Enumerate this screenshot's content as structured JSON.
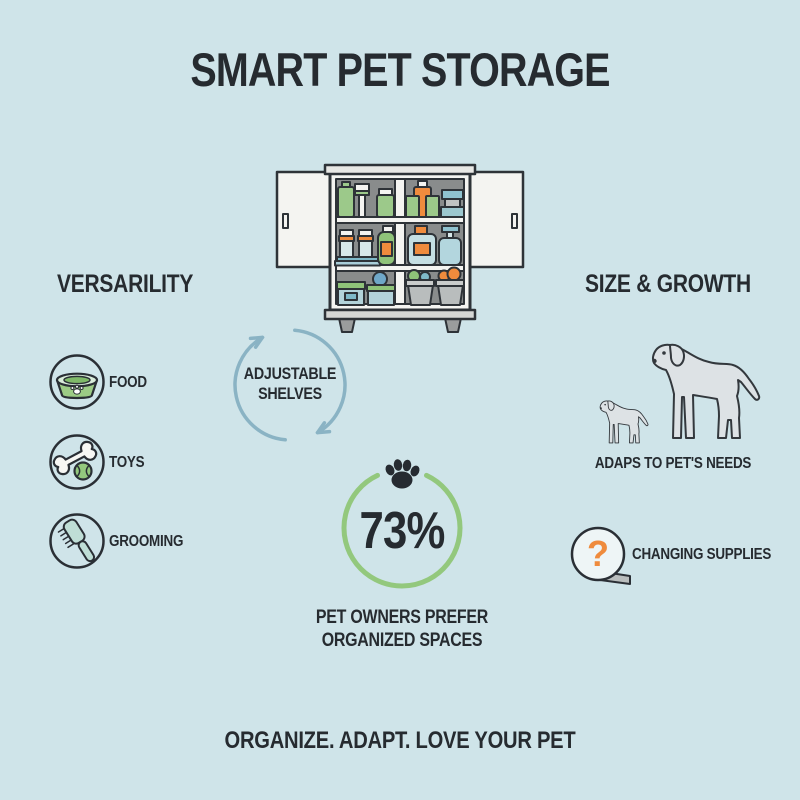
{
  "infographic": {
    "title": "SMART PET STORAGE",
    "tagline": "ORGANIZE. ADAPT. LOVE YOUR PET"
  },
  "versatility": {
    "heading": "VERSARILITY",
    "items": [
      {
        "icon": "pet-food-bowl-icon",
        "label": "FOOD"
      },
      {
        "icon": "bone-and-ball-icon",
        "label": "TOYS"
      },
      {
        "icon": "grooming-brush-icon",
        "label": "GROOMING"
      }
    ]
  },
  "cabinet": {
    "caption_line1": "ADJUSTABLE",
    "caption_line2": "SHELVES"
  },
  "size_growth": {
    "heading": "SIZE & GROWTH",
    "caption": "ADAPS TO PET'S NEEDS",
    "supplies": {
      "label": "CHANGING SUPPLIES",
      "symbol": "?"
    }
  },
  "stat": {
    "value": "73%",
    "caption_line1": "PET OWNERS PREFER",
    "caption_line2": "ORGANIZED SPACES"
  },
  "colors": {
    "background": "#cfe4e9",
    "text": "#262b30",
    "green": "#93c87d",
    "orange": "#ef8b3d",
    "arrow_blue": "#8ab3c4"
  }
}
